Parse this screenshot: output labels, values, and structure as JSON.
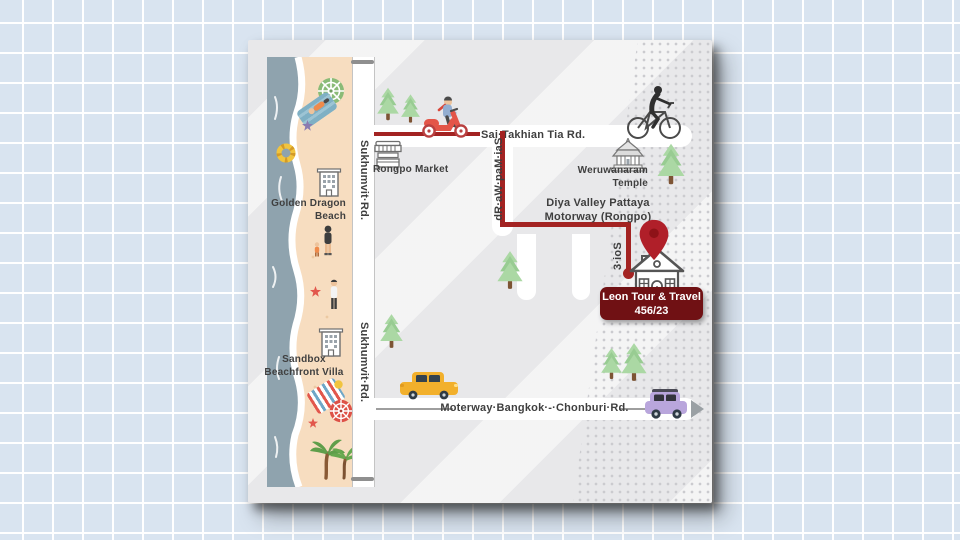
{
  "page": {
    "bg_color": "#d9e4f0",
    "grid_color": "#ffffff"
  },
  "map_card": {
    "bg_color": "#e8e8ea",
    "route_color": "#a32322",
    "pin_color": "#b01f29",
    "destination_badge": {
      "name": "Leon Tour & Travel",
      "address_number": "456/23",
      "bg_color": "#701114",
      "text_color": "#ffffff"
    },
    "roads": {
      "sukhumvit": {
        "label": "Sukhumvit·Rd."
      },
      "sai_takhian": {
        "label": "Sai·Takhian Tia Rd."
      },
      "sai_map_wa": {
        "label": "Sai·Map·Wa·Rd."
      },
      "soi_3": {
        "label": "Soi·3"
      },
      "diya_motorway": {
        "label_line1": "Diya Valley Pattaya",
        "label_line2": "Motorway (Rongpo)"
      },
      "bangkok_chonburi": {
        "label": "Moterway·Bangkok·-·Chonburi·Rd."
      }
    },
    "places": {
      "golden_dragon_beach": {
        "line1": "Golden Dragon",
        "line2": "Beach"
      },
      "rongpo_market": {
        "label": "Rongpo Market"
      },
      "weruwanaram_temple": {
        "line1": "Weruwanaram",
        "line2": "Temple"
      },
      "sandbox_villa": {
        "line1": "Sandbox",
        "line2": "Beachfront Villa"
      }
    },
    "icons": {
      "location-pin-icon": "red teardrop map pin",
      "house-icon": "destination house line art",
      "temple-icon": "thai temple line art",
      "market-stall-icon": "market stall line art",
      "hotel-building-icon": "multi-storey building line art",
      "pine-tree-icon": "green pine tree",
      "palm-tree-icon": "palm trees",
      "scooter-icon": "person riding red scooter",
      "bicycle-icon": "person riding bicycle",
      "yellow-car-icon": "yellow car",
      "purple-car-icon": "purple car",
      "umbrella-green-icon": "green beach umbrella",
      "umbrella-red-icon": "red beach umbrella",
      "swim-ring-icon": "yellow swim ring",
      "starfish-icon": "starfish",
      "beach-towel-icon": "beach towel with person",
      "beach-mat-icon": "striped beach mat",
      "person-icon": "person on beach"
    }
  }
}
